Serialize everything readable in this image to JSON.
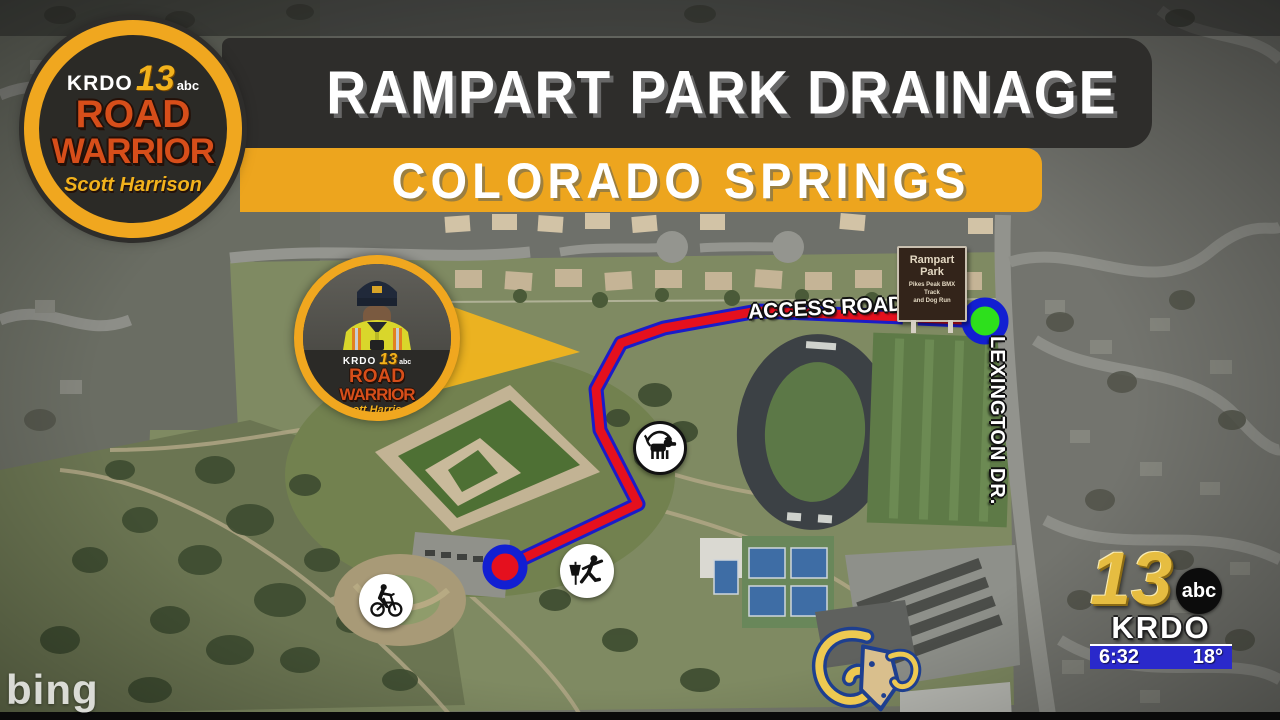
{
  "banner": {
    "title": "RAMPART PARK DRAINAGE",
    "subtitle": "COLORADO SPRINGS",
    "bar_color": "#2e2d2b",
    "accent_gold": "#eda51e"
  },
  "brand_badge": {
    "station": "KRDO",
    "channel": "13",
    "network": "abc",
    "show_top": "ROAD",
    "show_bottom": "WARRIOR",
    "host": "Scott Harrison"
  },
  "reporter_badge": {
    "station": "KRDO",
    "channel": "13",
    "network": "abc",
    "show_top": "ROAD",
    "show_bottom": "WARRIOR",
    "host": "Scott Harrison"
  },
  "map": {
    "attribution": "bing",
    "road_labels": [
      {
        "label": "ACCESS ROAD"
      },
      {
        "label": "LEXINGTON DR."
      }
    ],
    "park_sign": {
      "title_line1": "Rampart",
      "title_line2": "Park",
      "sub_line1": "Pikes Peak BMX",
      "sub_line2": "Track",
      "sub_line3": "and Dog Run"
    },
    "route": {
      "color": "#e5101e",
      "outline_color": "#1a1cc8",
      "start_marker_color": "#e5101e",
      "end_marker_color": "#2de01c",
      "marker_ring_color": "#121fd2"
    },
    "poi_icons": [
      {
        "name": "dog-walk-icon"
      },
      {
        "name": "disc-golf-icon"
      },
      {
        "name": "bmx-bike-icon"
      },
      {
        "name": "ram-mascot-logo"
      }
    ]
  },
  "station_bug": {
    "channel": "13",
    "network": "abc",
    "station": "KRDO",
    "time": "6:32",
    "temperature": "18°",
    "bar_color": "#2a29cb"
  }
}
